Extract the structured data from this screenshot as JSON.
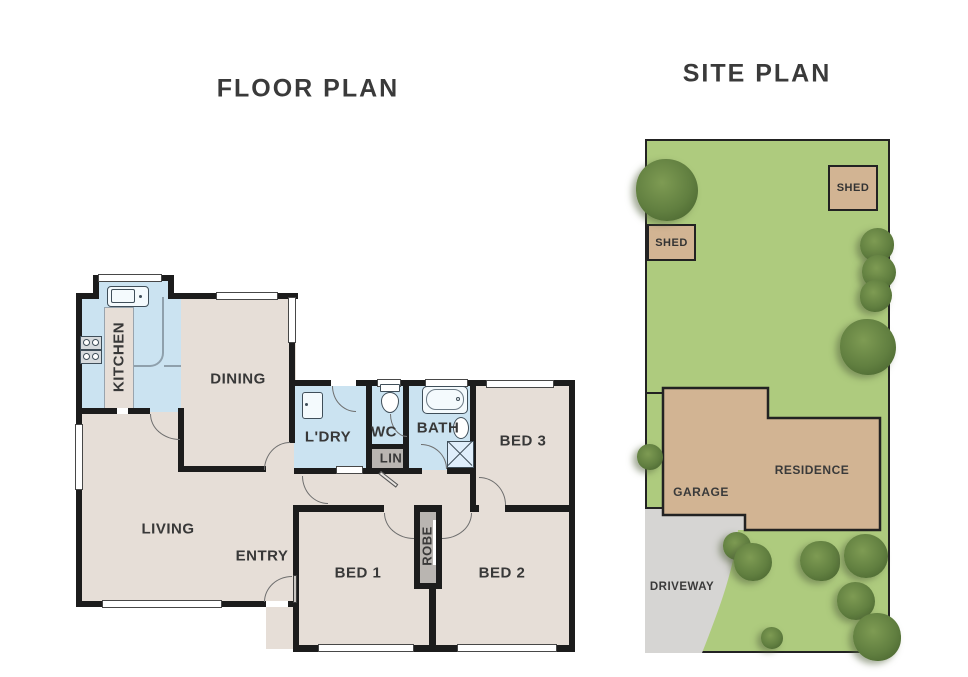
{
  "floor_plan": {
    "title": "FLOOR PLAN",
    "rooms": [
      {
        "label": "KITCHEN"
      },
      {
        "label": "DINING"
      },
      {
        "label": "LIVING"
      },
      {
        "label": "ENTRY"
      },
      {
        "label": "L'DRY"
      },
      {
        "label": "WC"
      },
      {
        "label": "LIN"
      },
      {
        "label": "BATH"
      },
      {
        "label": "BED 3"
      },
      {
        "label": "BED 1"
      },
      {
        "label": "ROBE"
      },
      {
        "label": "BED 2"
      }
    ],
    "fixtures": [
      "kitchen-sink",
      "cooktop",
      "laundry-trough",
      "toilet",
      "bathtub",
      "basin",
      "shower"
    ]
  },
  "site_plan": {
    "title": "SITE PLAN",
    "labels": {
      "shed_right": "SHED",
      "shed_left": "SHED",
      "residence": "RESIDENCE",
      "garage": "GARAGE",
      "driveway": "DRIVEWAY"
    }
  },
  "colors": {
    "wall": "#1c1c1c",
    "floor_beige": "#e6ded7",
    "wet_area_blue": "#cbe3f1",
    "closet_gray": "#b9b5b1",
    "lot_green": "#aecb7e",
    "building_tan": "#d2b493",
    "driveway_gray": "#d6d5d3",
    "tree_green": "#617f40",
    "label_dark": "#3a3a3a"
  }
}
